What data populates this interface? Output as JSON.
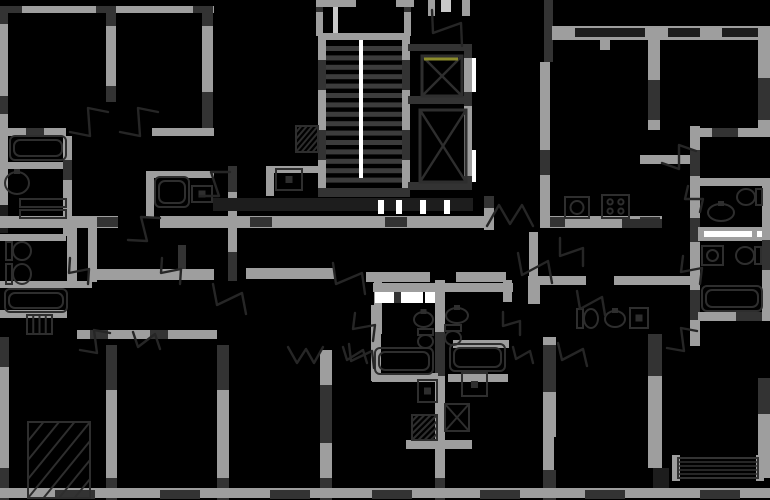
{
  "canvas": {
    "width": 770,
    "height": 500,
    "background": "#000000"
  },
  "palette": {
    "g": "#9e9e9e",
    "lg": "#c9c9c9",
    "d": "#333333",
    "dd": "#1d1d1d",
    "w": "#ffffff",
    "y": "#8b8b2b",
    "tread": "#3c3c3c",
    "outline": "#2e2e2e"
  },
  "plan": {
    "walls": [
      [
        0,
        6,
        214,
        7,
        "g"
      ],
      [
        0,
        6,
        22,
        7,
        "d"
      ],
      [
        96,
        6,
        20,
        7,
        "d"
      ],
      [
        193,
        6,
        20,
        7,
        "d"
      ],
      [
        0,
        8,
        8,
        225,
        "g"
      ],
      [
        0,
        8,
        8,
        16,
        "d"
      ],
      [
        0,
        96,
        8,
        18,
        "d"
      ],
      [
        0,
        205,
        8,
        28,
        "dd"
      ],
      [
        106,
        8,
        10,
        94,
        "g"
      ],
      [
        106,
        8,
        10,
        18,
        "d"
      ],
      [
        106,
        86,
        10,
        16,
        "d"
      ],
      [
        202,
        8,
        11,
        128,
        "g"
      ],
      [
        202,
        8,
        11,
        18,
        "d"
      ],
      [
        202,
        92,
        11,
        44,
        "d"
      ],
      [
        0,
        128,
        66,
        8,
        "g"
      ],
      [
        26,
        128,
        18,
        8,
        "d"
      ],
      [
        152,
        128,
        62,
        8,
        "g"
      ],
      [
        0,
        162,
        66,
        7,
        "g"
      ],
      [
        63,
        136,
        9,
        100,
        "g"
      ],
      [
        63,
        160,
        9,
        20,
        "d"
      ],
      [
        0,
        234,
        66,
        7,
        "g"
      ],
      [
        0,
        281,
        92,
        7,
        "g"
      ],
      [
        0,
        310,
        67,
        8,
        "g"
      ],
      [
        67,
        225,
        10,
        63,
        "g"
      ],
      [
        178,
        245,
        8,
        26,
        "d"
      ],
      [
        0,
        337,
        9,
        163,
        "g"
      ],
      [
        0,
        337,
        9,
        30,
        "d"
      ],
      [
        0,
        468,
        9,
        32,
        "d"
      ],
      [
        77,
        330,
        140,
        9,
        "g"
      ],
      [
        90,
        330,
        18,
        9,
        "d"
      ],
      [
        150,
        330,
        18,
        9,
        "d"
      ],
      [
        0,
        216,
        118,
        12,
        "g"
      ],
      [
        96,
        217,
        22,
        10,
        "d"
      ],
      [
        160,
        216,
        326,
        12,
        "g"
      ],
      [
        250,
        217,
        22,
        10,
        "d"
      ],
      [
        385,
        217,
        22,
        10,
        "d"
      ],
      [
        540,
        216,
        122,
        12,
        "g"
      ],
      [
        545,
        217,
        20,
        10,
        "d"
      ],
      [
        640,
        217,
        20,
        10,
        "d"
      ],
      [
        88,
        216,
        9,
        66,
        "g"
      ],
      [
        88,
        269,
        126,
        11,
        "g"
      ],
      [
        246,
        268,
        88,
        11,
        "g"
      ],
      [
        366,
        272,
        64,
        10,
        "g"
      ],
      [
        374,
        272,
        8,
        62,
        "g"
      ],
      [
        373,
        283,
        140,
        9,
        "g"
      ],
      [
        375,
        292,
        48,
        11,
        "w"
      ],
      [
        394,
        292,
        7,
        11,
        "d"
      ],
      [
        425,
        292,
        10,
        11,
        "w"
      ],
      [
        456,
        272,
        50,
        10,
        "g"
      ],
      [
        503,
        280,
        9,
        22,
        "g"
      ],
      [
        528,
        276,
        12,
        28,
        "g"
      ],
      [
        540,
        276,
        46,
        9,
        "g"
      ],
      [
        614,
        276,
        76,
        9,
        "g"
      ],
      [
        484,
        196,
        10,
        34,
        "g"
      ],
      [
        484,
        196,
        10,
        12,
        "d"
      ],
      [
        529,
        232,
        9,
        46,
        "g"
      ],
      [
        150,
        171,
        64,
        7,
        "g"
      ],
      [
        146,
        171,
        8,
        46,
        "g"
      ],
      [
        228,
        166,
        9,
        115,
        "g"
      ],
      [
        228,
        166,
        9,
        26,
        "d"
      ],
      [
        228,
        252,
        9,
        29,
        "d"
      ],
      [
        266,
        166,
        8,
        30,
        "g"
      ],
      [
        266,
        166,
        53,
        7,
        "g"
      ],
      [
        213,
        198,
        260,
        13,
        "dd"
      ],
      [
        378,
        200,
        6,
        14,
        "w"
      ],
      [
        396,
        200,
        6,
        14,
        "w"
      ],
      [
        420,
        200,
        6,
        14,
        "w"
      ],
      [
        444,
        200,
        6,
        14,
        "w"
      ],
      [
        316,
        0,
        7,
        36,
        "g"
      ],
      [
        316,
        0,
        7,
        12,
        "d"
      ],
      [
        333,
        0,
        5,
        36,
        "lg"
      ],
      [
        404,
        0,
        7,
        36,
        "g"
      ],
      [
        404,
        0,
        7,
        12,
        "d"
      ],
      [
        316,
        0,
        40,
        7,
        "g"
      ],
      [
        396,
        0,
        18,
        7,
        "g"
      ],
      [
        318,
        33,
        92,
        7,
        "g"
      ],
      [
        318,
        33,
        8,
        163,
        "g"
      ],
      [
        402,
        33,
        8,
        163,
        "g"
      ],
      [
        318,
        188,
        92,
        9,
        "d"
      ],
      [
        318,
        60,
        8,
        30,
        "d"
      ],
      [
        318,
        130,
        8,
        30,
        "d"
      ],
      [
        402,
        60,
        8,
        30,
        "d"
      ],
      [
        402,
        130,
        8,
        30,
        "d"
      ],
      [
        428,
        0,
        7,
        16,
        "g"
      ],
      [
        441,
        0,
        10,
        12,
        "lg"
      ],
      [
        462,
        0,
        8,
        16,
        "g"
      ],
      [
        408,
        44,
        64,
        7,
        "d"
      ],
      [
        464,
        44,
        8,
        146,
        "g"
      ],
      [
        464,
        44,
        8,
        14,
        "d"
      ],
      [
        464,
        92,
        8,
        14,
        "d"
      ],
      [
        464,
        176,
        8,
        14,
        "d"
      ],
      [
        408,
        96,
        64,
        8,
        "d"
      ],
      [
        408,
        182,
        64,
        8,
        "d"
      ],
      [
        472,
        58,
        4,
        34,
        "w"
      ],
      [
        472,
        150,
        4,
        32,
        "w"
      ],
      [
        544,
        0,
        9,
        62,
        "d"
      ],
      [
        540,
        62,
        10,
        166,
        "g"
      ],
      [
        540,
        150,
        10,
        25,
        "d"
      ],
      [
        552,
        26,
        218,
        14,
        "g"
      ],
      [
        575,
        28,
        70,
        9,
        "dd"
      ],
      [
        668,
        28,
        32,
        9,
        "dd"
      ],
      [
        722,
        28,
        38,
        9,
        "dd"
      ],
      [
        600,
        40,
        10,
        10,
        "g"
      ],
      [
        648,
        40,
        12,
        90,
        "g"
      ],
      [
        648,
        80,
        12,
        40,
        "d"
      ],
      [
        758,
        26,
        12,
        110,
        "g"
      ],
      [
        758,
        78,
        12,
        42,
        "d"
      ],
      [
        700,
        128,
        70,
        9,
        "g"
      ],
      [
        712,
        128,
        26,
        9,
        "d"
      ],
      [
        640,
        155,
        58,
        9,
        "g"
      ],
      [
        690,
        126,
        10,
        220,
        "g"
      ],
      [
        690,
        150,
        10,
        26,
        "d"
      ],
      [
        690,
        218,
        10,
        24,
        "d"
      ],
      [
        690,
        290,
        10,
        30,
        "d"
      ],
      [
        698,
        178,
        72,
        8,
        "g"
      ],
      [
        698,
        227,
        72,
        14,
        "g"
      ],
      [
        704,
        231,
        48,
        6,
        "w"
      ],
      [
        757,
        231,
        9,
        6,
        "w"
      ],
      [
        698,
        312,
        72,
        9,
        "g"
      ],
      [
        736,
        312,
        34,
        9,
        "d"
      ],
      [
        762,
        178,
        8,
        143,
        "g"
      ],
      [
        762,
        240,
        8,
        30,
        "d"
      ],
      [
        106,
        345,
        11,
        155,
        "g"
      ],
      [
        106,
        345,
        11,
        45,
        "d"
      ],
      [
        106,
        478,
        11,
        22,
        "d"
      ],
      [
        217,
        345,
        12,
        155,
        "g"
      ],
      [
        217,
        345,
        12,
        45,
        "d"
      ],
      [
        217,
        478,
        12,
        22,
        "d"
      ],
      [
        320,
        350,
        12,
        150,
        "g"
      ],
      [
        320,
        385,
        12,
        58,
        "d"
      ],
      [
        320,
        478,
        12,
        22,
        "d"
      ],
      [
        371,
        305,
        10,
        76,
        "g"
      ],
      [
        435,
        280,
        10,
        220,
        "g"
      ],
      [
        435,
        332,
        10,
        44,
        "d"
      ],
      [
        435,
        478,
        10,
        22,
        "d"
      ],
      [
        543,
        337,
        13,
        100,
        "g"
      ],
      [
        543,
        345,
        13,
        47,
        "d"
      ],
      [
        543,
        437,
        11,
        63,
        "g"
      ],
      [
        543,
        470,
        13,
        30,
        "d"
      ],
      [
        648,
        334,
        14,
        134,
        "g"
      ],
      [
        648,
        334,
        14,
        42,
        "d"
      ],
      [
        653,
        468,
        16,
        30,
        "dd"
      ],
      [
        758,
        378,
        12,
        100,
        "g"
      ],
      [
        758,
        378,
        12,
        36,
        "d"
      ],
      [
        672,
        455,
        8,
        26,
        "g"
      ],
      [
        756,
        455,
        8,
        26,
        "g"
      ],
      [
        372,
        373,
        66,
        9,
        "g"
      ],
      [
        448,
        374,
        60,
        8,
        "g"
      ],
      [
        406,
        440,
        66,
        9,
        "g"
      ],
      [
        453,
        340,
        56,
        8,
        "g"
      ],
      [
        0,
        488,
        770,
        10,
        "g"
      ],
      [
        55,
        490,
        40,
        9,
        "d"
      ],
      [
        160,
        490,
        40,
        9,
        "d"
      ],
      [
        270,
        490,
        40,
        9,
        "d"
      ],
      [
        372,
        490,
        40,
        9,
        "d"
      ],
      [
        480,
        490,
        40,
        9,
        "d"
      ],
      [
        585,
        490,
        40,
        9,
        "d"
      ],
      [
        700,
        490,
        40,
        9,
        "d"
      ]
    ],
    "stairs": {
      "x": 326,
      "y": 46,
      "w": 76,
      "treads": 15,
      "tread_h": 5,
      "step": 9.4,
      "stringer": {
        "x": 359,
        "y": 40,
        "w": 4,
        "h": 138
      }
    },
    "elevators": [
      {
        "x": 422,
        "y": 56,
        "w": 40,
        "h": 40
      },
      {
        "x": 420,
        "y": 110,
        "w": 46,
        "h": 72
      }
    ],
    "accent_lines": [
      [
        424,
        59,
        458,
        59,
        "y",
        3
      ]
    ],
    "louver": {
      "x": 678,
      "y": 458,
      "w": 80,
      "h": 20,
      "lines": 5
    },
    "doors": [
      [
        70,
        132,
        108,
        112
      ],
      [
        120,
        132,
        158,
        112
      ],
      [
        432,
        10,
        462,
        46
      ],
      [
        200,
        196,
        230,
        172
      ],
      [
        128,
        240,
        160,
        218
      ],
      [
        162,
        258,
        180,
        284
      ],
      [
        70,
        258,
        88,
        284
      ],
      [
        213,
        284,
        246,
        314
      ],
      [
        333,
        263,
        365,
        294
      ],
      [
        518,
        253,
        552,
        283
      ],
      [
        560,
        238,
        583,
        266
      ],
      [
        577,
        291,
        605,
        315
      ],
      [
        662,
        163,
        696,
        151
      ],
      [
        688,
        186,
        700,
        212
      ],
      [
        683,
        256,
        700,
        284
      ],
      [
        667,
        348,
        697,
        331
      ],
      [
        80,
        350,
        110,
        333
      ],
      [
        133,
        332,
        160,
        349
      ],
      [
        349,
        344,
        374,
        368
      ],
      [
        355,
        313,
        373,
        341
      ],
      [
        343,
        347,
        367,
        363
      ],
      [
        503,
        312,
        520,
        335
      ],
      [
        513,
        347,
        533,
        363
      ],
      [
        558,
        343,
        587,
        366
      ],
      [
        487,
        226,
        533,
        226,
        "w"
      ],
      [
        323,
        347,
        288,
        347,
        "w"
      ]
    ],
    "fixtures": [
      {
        "t": "tub",
        "x": 10,
        "y": 136,
        "w": 56,
        "h": 24
      },
      {
        "t": "sink",
        "x": 4,
        "y": 171,
        "w": 26,
        "h": 24
      },
      {
        "t": "bar",
        "x": 20,
        "y": 199,
        "w": 46,
        "h": 8
      },
      {
        "t": "bar",
        "x": 20,
        "y": 210,
        "w": 46,
        "h": 8
      },
      {
        "t": "toilet",
        "x": 6,
        "y": 241,
        "w": 26,
        "h": 20,
        "r": 0
      },
      {
        "t": "toilet",
        "x": 6,
        "y": 263,
        "w": 26,
        "h": 22,
        "r": 0
      },
      {
        "t": "tub",
        "x": 5,
        "y": 289,
        "w": 62,
        "h": 23
      },
      {
        "t": "rad",
        "x": 27,
        "y": 315,
        "w": 25,
        "h": 19
      },
      {
        "t": "hatch",
        "x": 28,
        "y": 422,
        "w": 62,
        "h": 76
      },
      {
        "t": "tub",
        "x": 155,
        "y": 177,
        "w": 34,
        "h": 30
      },
      {
        "t": "boxdot",
        "x": 192,
        "y": 186,
        "w": 20,
        "h": 16
      },
      {
        "t": "boxdot",
        "x": 276,
        "y": 169,
        "w": 26,
        "h": 21
      },
      {
        "t": "hatch",
        "x": 296,
        "y": 126,
        "w": 22,
        "h": 26
      },
      {
        "t": "washer",
        "x": 565,
        "y": 197,
        "w": 24,
        "h": 21
      },
      {
        "t": "stove",
        "x": 602,
        "y": 195,
        "w": 27,
        "h": 23
      },
      {
        "t": "bar",
        "x": 622,
        "y": 219,
        "w": 40,
        "h": 9,
        "dark": true
      },
      {
        "t": "toilet",
        "x": 736,
        "y": 188,
        "w": 26,
        "h": 18,
        "r": 1
      },
      {
        "t": "sink",
        "x": 707,
        "y": 203,
        "w": 28,
        "h": 19
      },
      {
        "t": "washer",
        "x": 702,
        "y": 246,
        "w": 21,
        "h": 19
      },
      {
        "t": "toilet",
        "x": 735,
        "y": 246,
        "w": 26,
        "h": 19,
        "r": 1
      },
      {
        "t": "tub",
        "x": 702,
        "y": 286,
        "w": 60,
        "h": 25
      },
      {
        "t": "toilet",
        "x": 577,
        "y": 308,
        "w": 22,
        "h": 21,
        "r": 0
      },
      {
        "t": "sink",
        "x": 604,
        "y": 310,
        "w": 22,
        "h": 18
      },
      {
        "t": "boxdot",
        "x": 630,
        "y": 308,
        "w": 18,
        "h": 20
      },
      {
        "t": "sink",
        "x": 413,
        "y": 311,
        "w": 21,
        "h": 17
      },
      {
        "t": "toilet",
        "x": 416,
        "y": 329,
        "w": 19,
        "h": 19,
        "r": 2
      },
      {
        "t": "sink",
        "x": 445,
        "y": 307,
        "w": 24,
        "h": 17
      },
      {
        "t": "toilet",
        "x": 443,
        "y": 325,
        "w": 20,
        "h": 20,
        "r": 2
      },
      {
        "t": "tub",
        "x": 375,
        "y": 348,
        "w": 58,
        "h": 26
      },
      {
        "t": "tub",
        "x": 450,
        "y": 344,
        "w": 55,
        "h": 27
      },
      {
        "t": "boxdot",
        "x": 462,
        "y": 373,
        "w": 25,
        "h": 23
      },
      {
        "t": "xbox",
        "x": 445,
        "y": 404,
        "w": 24,
        "h": 27
      },
      {
        "t": "hatch",
        "x": 412,
        "y": 415,
        "w": 25,
        "h": 25
      },
      {
        "t": "boxdot",
        "x": 418,
        "y": 380,
        "w": 19,
        "h": 22
      }
    ]
  }
}
